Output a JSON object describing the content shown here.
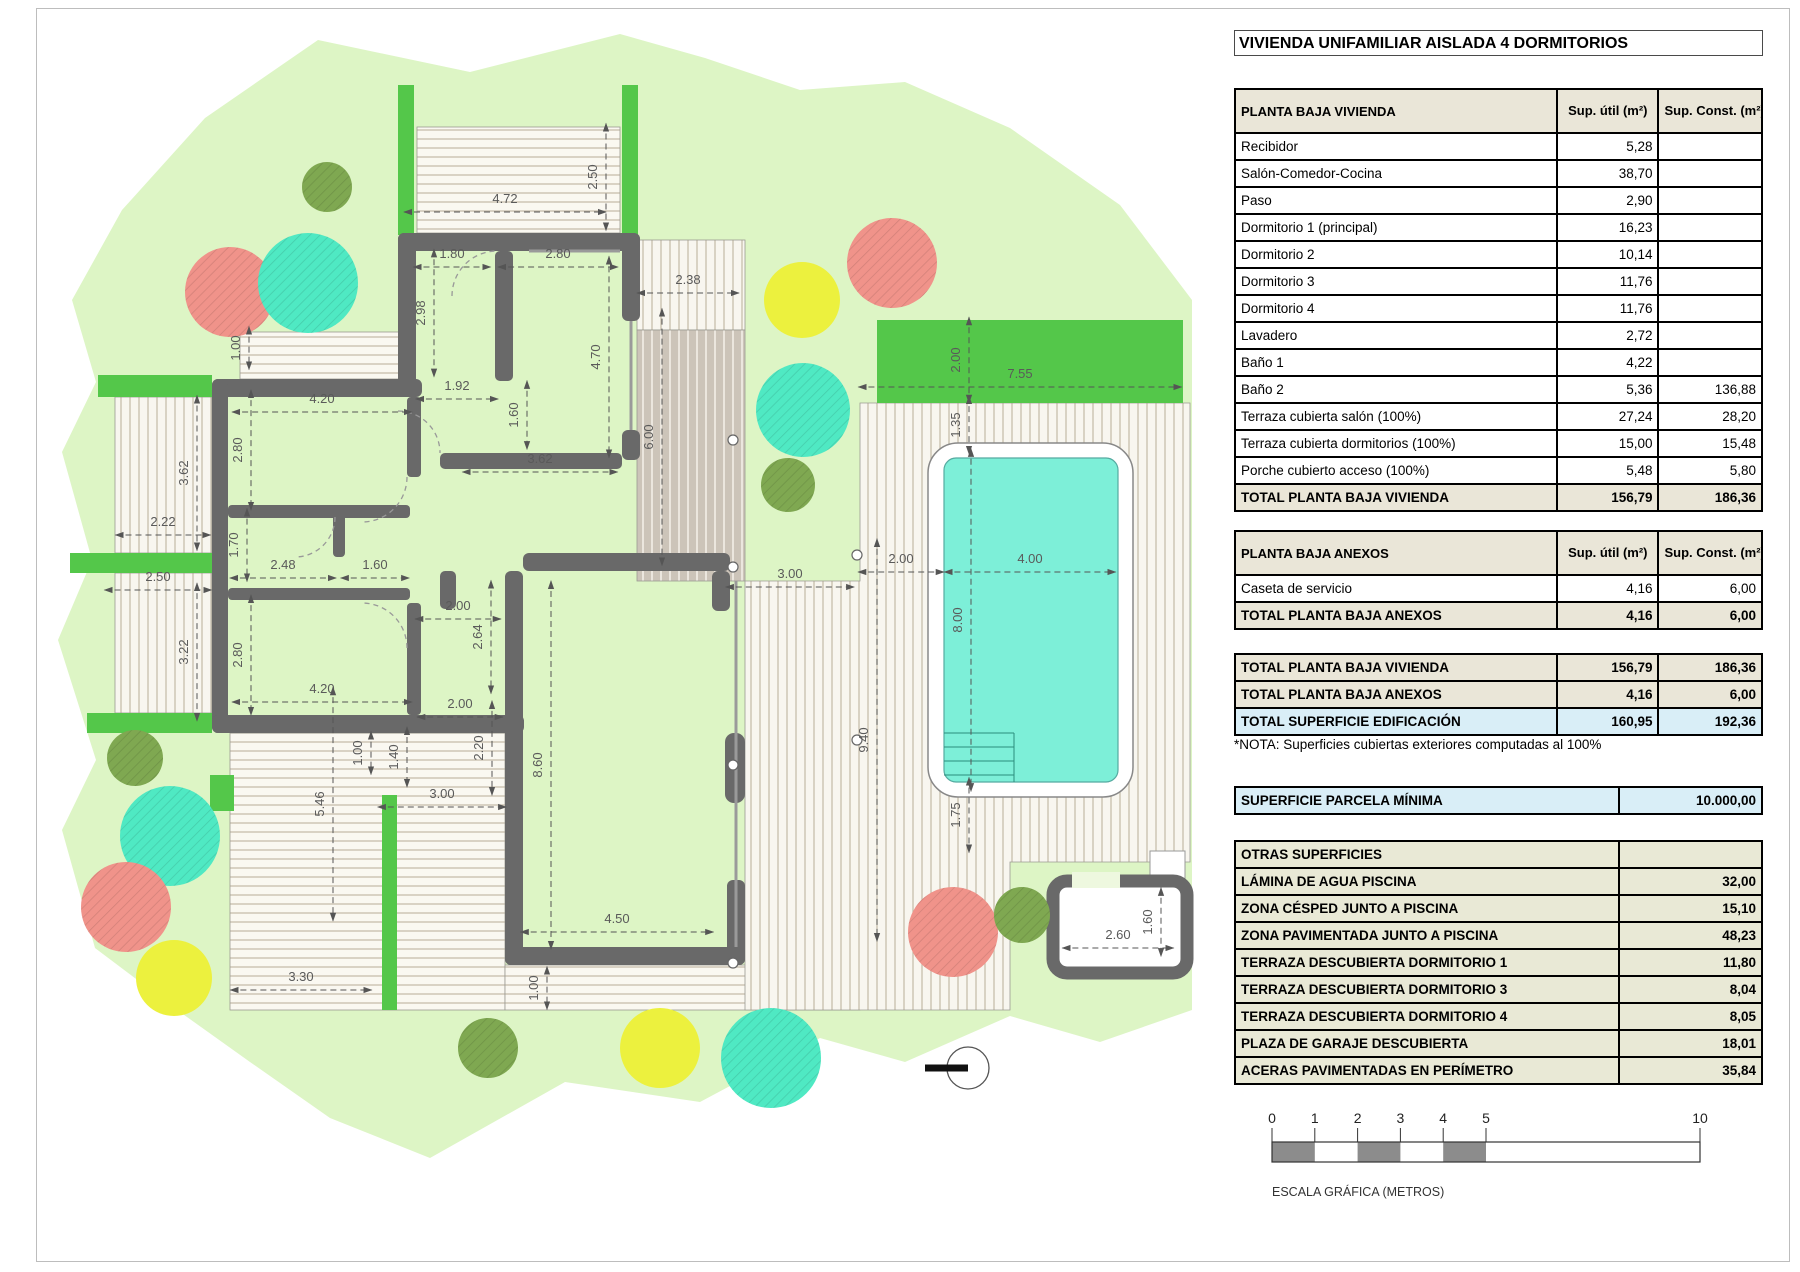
{
  "title": "VIVIENDA UNIFAMILIAR AISLADA 4 DORMITORIOS",
  "tables": {
    "vivienda": {
      "header": "PLANTA BAJA VIVIENDA",
      "col_util": "Sup. útil\n(m²)",
      "col_const": "Sup. Const.\n(m²)",
      "rows": [
        {
          "label": "Recibidor",
          "util": "5,28",
          "const": ""
        },
        {
          "label": "Salón-Comedor-Cocina",
          "util": "38,70",
          "const": ""
        },
        {
          "label": "Paso",
          "util": "2,90",
          "const": ""
        },
        {
          "label": "Dormitorio 1 (principal)",
          "util": "16,23",
          "const": ""
        },
        {
          "label": "Dormitorio 2",
          "util": "10,14",
          "const": ""
        },
        {
          "label": "Dormitorio 3",
          "util": "11,76",
          "const": ""
        },
        {
          "label": "Dormitorio 4",
          "util": "11,76",
          "const": ""
        },
        {
          "label": "Lavadero",
          "util": "2,72",
          "const": ""
        },
        {
          "label": "Baño 1",
          "util": "4,22",
          "const": ""
        },
        {
          "label": "Baño 2",
          "util": "5,36",
          "const": "136,88"
        },
        {
          "label": "Terraza cubierta salón (100%)",
          "util": "27,24",
          "const": "28,20"
        },
        {
          "label": "Terraza cubierta dormitorios (100%)",
          "util": "15,00",
          "const": "15,48"
        },
        {
          "label": "Porche cubierto acceso (100%)",
          "util": "5,48",
          "const": "5,80"
        }
      ],
      "total": {
        "label": "TOTAL PLANTA BAJA VIVIENDA",
        "util": "156,79",
        "const": "186,36"
      }
    },
    "anexos": {
      "header": "PLANTA BAJA ANEXOS",
      "col_util": "Sup. útil\n(m²)",
      "col_const": "Sup. Const.\n(m²)",
      "rows": [
        {
          "label": "Caseta de servicio",
          "util": "4,16",
          "const": "6,00"
        }
      ],
      "total": {
        "label": "TOTAL PLANTA BAJA ANEXOS",
        "util": "4,16",
        "const": "6,00"
      }
    },
    "resumen": {
      "rows": [
        {
          "label": "TOTAL PLANTA BAJA VIVIENDA",
          "util": "156,79",
          "const": "186,36"
        },
        {
          "label": "TOTAL PLANTA BAJA ANEXOS",
          "util": "4,16",
          "const": "6,00"
        },
        {
          "label": "TOTAL SUPERFICIE EDIFICACIÓN",
          "util": "160,95",
          "const": "192,36"
        }
      ]
    },
    "nota": "*NOTA: Superficies cubiertas exteriores computadas al 100%",
    "parcela": {
      "label": "SUPERFICIE PARCELA MÍNIMA",
      "value": "10.000,00"
    },
    "otras": {
      "header": "OTRAS SUPERFICIES",
      "rows": [
        {
          "label": "LÁMINA DE AGUA PISCINA",
          "value": "32,00"
        },
        {
          "label": "ZONA CÉSPED JUNTO A PISCINA",
          "value": "15,10"
        },
        {
          "label": "ZONA PAVIMENTADA JUNTO A PISCINA",
          "value": "48,23"
        },
        {
          "label": "TERRAZA DESCUBIERTA DORMITORIO 1",
          "value": "11,80"
        },
        {
          "label": "TERRAZA DESCUBIERTA DORMITORIO 3",
          "value": "8,04"
        },
        {
          "label": "TERRAZA DESCUBIERTA DORMITORIO 4",
          "value": "8,05"
        },
        {
          "label": "PLAZA DE GARAJE DESCUBIERTA",
          "value": "18,01"
        },
        {
          "label": "ACERAS PAVIMENTADAS EN PERÍMETRO",
          "value": "35,84"
        }
      ]
    }
  },
  "scale_bar": {
    "caption": "ESCALA GRÁFICA (METROS)",
    "ticks": [
      "0",
      "1",
      "2",
      "3",
      "4",
      "5",
      "10"
    ],
    "tick_meters": [
      0,
      1,
      2,
      3,
      4,
      5,
      10
    ],
    "meter_px": 42.8,
    "filled_segments": [
      [
        0,
        1
      ],
      [
        2,
        3
      ],
      [
        4,
        5
      ]
    ]
  },
  "plan": {
    "colors": {
      "garden": "#ddf5c5",
      "pergola": "#54c74a",
      "wall": "#696969",
      "pool_water": "#7defd8",
      "tree_salmon": "#f0938a",
      "tree_teal": "#4fe9c3",
      "tree_yellow": "#ecf13e",
      "tree_olive": "#7fa851",
      "dim_text": "#5a5a5a"
    },
    "dimensions": [
      {
        "t": "2.50",
        "x": 597,
        "y": 177,
        "r": -90
      },
      {
        "t": "4.72",
        "x": 505,
        "y": 203,
        "r": 0
      },
      {
        "t": "1.80",
        "x": 452,
        "y": 258,
        "r": 0
      },
      {
        "t": "2.80",
        "x": 558,
        "y": 258,
        "r": 0
      },
      {
        "t": "2.38",
        "x": 688,
        "y": 284,
        "r": 0
      },
      {
        "t": "2.98",
        "x": 425,
        "y": 313,
        "r": -90
      },
      {
        "t": "4.70",
        "x": 600,
        "y": 357,
        "r": -90
      },
      {
        "t": "1.00",
        "x": 240,
        "y": 348,
        "r": -90
      },
      {
        "t": "1.92",
        "x": 457,
        "y": 390,
        "r": 0
      },
      {
        "t": "1.60",
        "x": 518,
        "y": 415,
        "r": -90
      },
      {
        "t": "3.62",
        "x": 540,
        "y": 463,
        "r": 0
      },
      {
        "t": "6.00",
        "x": 653,
        "y": 437,
        "r": -90
      },
      {
        "t": "4.20",
        "x": 322,
        "y": 403,
        "r": 0
      },
      {
        "t": "2.80",
        "x": 242,
        "y": 450,
        "r": -90
      },
      {
        "t": "3.62",
        "x": 188,
        "y": 473,
        "r": -90
      },
      {
        "t": "2.22",
        "x": 163,
        "y": 526,
        "r": 0
      },
      {
        "t": "1.70",
        "x": 238,
        "y": 545,
        "r": -90
      },
      {
        "t": "2.48",
        "x": 283,
        "y": 569,
        "r": 0
      },
      {
        "t": "1.60",
        "x": 375,
        "y": 569,
        "r": 0
      },
      {
        "t": "2.50",
        "x": 158,
        "y": 581,
        "r": 0
      },
      {
        "t": "3.22",
        "x": 188,
        "y": 652,
        "r": -90
      },
      {
        "t": "2.80",
        "x": 242,
        "y": 655,
        "r": -90
      },
      {
        "t": "4.20",
        "x": 322,
        "y": 693,
        "r": 0
      },
      {
        "t": "1.00",
        "x": 362,
        "y": 753,
        "r": -90
      },
      {
        "t": "1.40",
        "x": 398,
        "y": 757,
        "r": -90
      },
      {
        "t": "2.00",
        "x": 458,
        "y": 610,
        "r": 0
      },
      {
        "t": "2.64",
        "x": 482,
        "y": 637,
        "r": -90
      },
      {
        "t": "2.00",
        "x": 460,
        "y": 708,
        "r": 0
      },
      {
        "t": "2.20",
        "x": 483,
        "y": 748,
        "r": -90
      },
      {
        "t": "8.60",
        "x": 542,
        "y": 765,
        "r": -90
      },
      {
        "t": "3.00",
        "x": 442,
        "y": 798,
        "r": 0
      },
      {
        "t": "4.50",
        "x": 617,
        "y": 923,
        "r": 0
      },
      {
        "t": "1.00",
        "x": 538,
        "y": 988,
        "r": -90
      },
      {
        "t": "5.46",
        "x": 324,
        "y": 804,
        "r": -90
      },
      {
        "t": "3.30",
        "x": 301,
        "y": 981,
        "r": 0
      },
      {
        "t": "3.00",
        "x": 790,
        "y": 578,
        "r": 0
      },
      {
        "t": "2.00",
        "x": 901,
        "y": 563,
        "r": 0
      },
      {
        "t": "2.00",
        "x": 960,
        "y": 360,
        "r": -90
      },
      {
        "t": "7.55",
        "x": 1020,
        "y": 378,
        "r": 0
      },
      {
        "t": "1.35",
        "x": 960,
        "y": 425,
        "r": -90
      },
      {
        "t": "4.00",
        "x": 1030,
        "y": 563,
        "r": 0
      },
      {
        "t": "8.00",
        "x": 962,
        "y": 620,
        "r": -90
      },
      {
        "t": "9.40",
        "x": 868,
        "y": 740,
        "r": -90
      },
      {
        "t": "1.75",
        "x": 960,
        "y": 815,
        "r": -90
      },
      {
        "t": "2.60",
        "x": 1118,
        "y": 939,
        "r": 0
      },
      {
        "t": "1.60",
        "x": 1152,
        "y": 922,
        "r": -90
      }
    ],
    "trees": [
      {
        "x": 230,
        "y": 292,
        "rad": 45,
        "c": "salmon"
      },
      {
        "x": 308,
        "y": 283,
        "rad": 50,
        "c": "teal"
      },
      {
        "x": 327,
        "y": 187,
        "rad": 25,
        "c": "olive"
      },
      {
        "x": 802,
        "y": 300,
        "rad": 38,
        "c": "yellow"
      },
      {
        "x": 892,
        "y": 263,
        "rad": 45,
        "c": "salmon"
      },
      {
        "x": 803,
        "y": 410,
        "rad": 47,
        "c": "teal"
      },
      {
        "x": 788,
        "y": 485,
        "rad": 27,
        "c": "olive"
      },
      {
        "x": 135,
        "y": 758,
        "rad": 28,
        "c": "olive"
      },
      {
        "x": 170,
        "y": 836,
        "rad": 50,
        "c": "teal"
      },
      {
        "x": 126,
        "y": 907,
        "rad": 45,
        "c": "salmon"
      },
      {
        "x": 174,
        "y": 978,
        "rad": 38,
        "c": "yellow"
      },
      {
        "x": 488,
        "y": 1048,
        "rad": 30,
        "c": "olive"
      },
      {
        "x": 660,
        "y": 1048,
        "rad": 40,
        "c": "yellow"
      },
      {
        "x": 771,
        "y": 1058,
        "rad": 50,
        "c": "teal"
      },
      {
        "x": 953,
        "y": 932,
        "rad": 45,
        "c": "salmon"
      },
      {
        "x": 1022,
        "y": 915,
        "rad": 28,
        "c": "olive"
      }
    ]
  }
}
